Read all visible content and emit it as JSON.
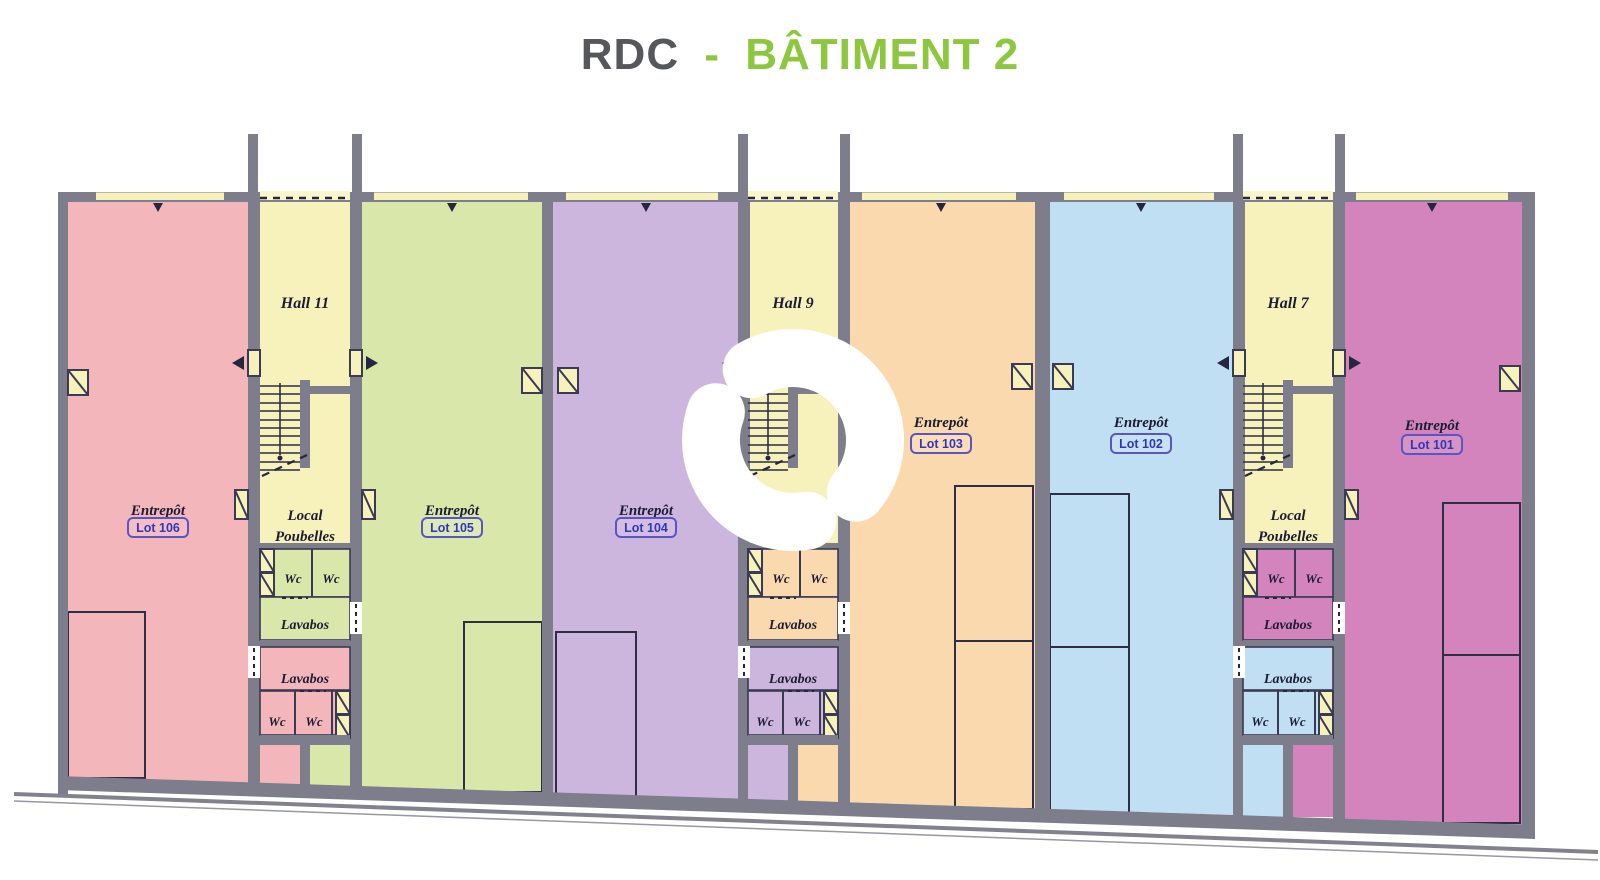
{
  "title": {
    "floor_label": "RDC",
    "separator": "-",
    "building_label": "BÂTIMENT 2"
  },
  "plan": {
    "units": [
      {
        "type_label": "Entrepôt",
        "lot_label": "Lot 106",
        "color": "#f3b7bb"
      },
      {
        "type_label": "Entrepôt",
        "lot_label": "Lot 105",
        "color": "#d9e7ab"
      },
      {
        "type_label": "Entrepôt",
        "lot_label": "Lot 104",
        "color": "#cdb6dd"
      },
      {
        "type_label": "Entrepôt",
        "lot_label": "Lot 103",
        "color": "#fbd9af"
      },
      {
        "type_label": "Entrepôt",
        "lot_label": "Lot 102",
        "color": "#c1dff3"
      },
      {
        "type_label": "Entrepôt",
        "lot_label": "Lot 101",
        "color": "#d384bd"
      }
    ],
    "halls": [
      {
        "label": "Hall 11"
      },
      {
        "label": "Hall 9"
      },
      {
        "label": "Hall 7"
      }
    ],
    "core_rooms": {
      "local_poubelles_line1": "Local",
      "local_poubelles_line2": "Poubelles",
      "wc_label": "Wc",
      "lavabos_label": "Lavabos"
    },
    "colors": {
      "wall": "#7d7d8c",
      "hall_yellow": "#f7f2bb",
      "lot_text": "#3136bd",
      "lot_border": "#5b55c4",
      "title_gray": "#55575b",
      "title_green": "#8dc63f",
      "watermark": "#ffffff"
    }
  }
}
